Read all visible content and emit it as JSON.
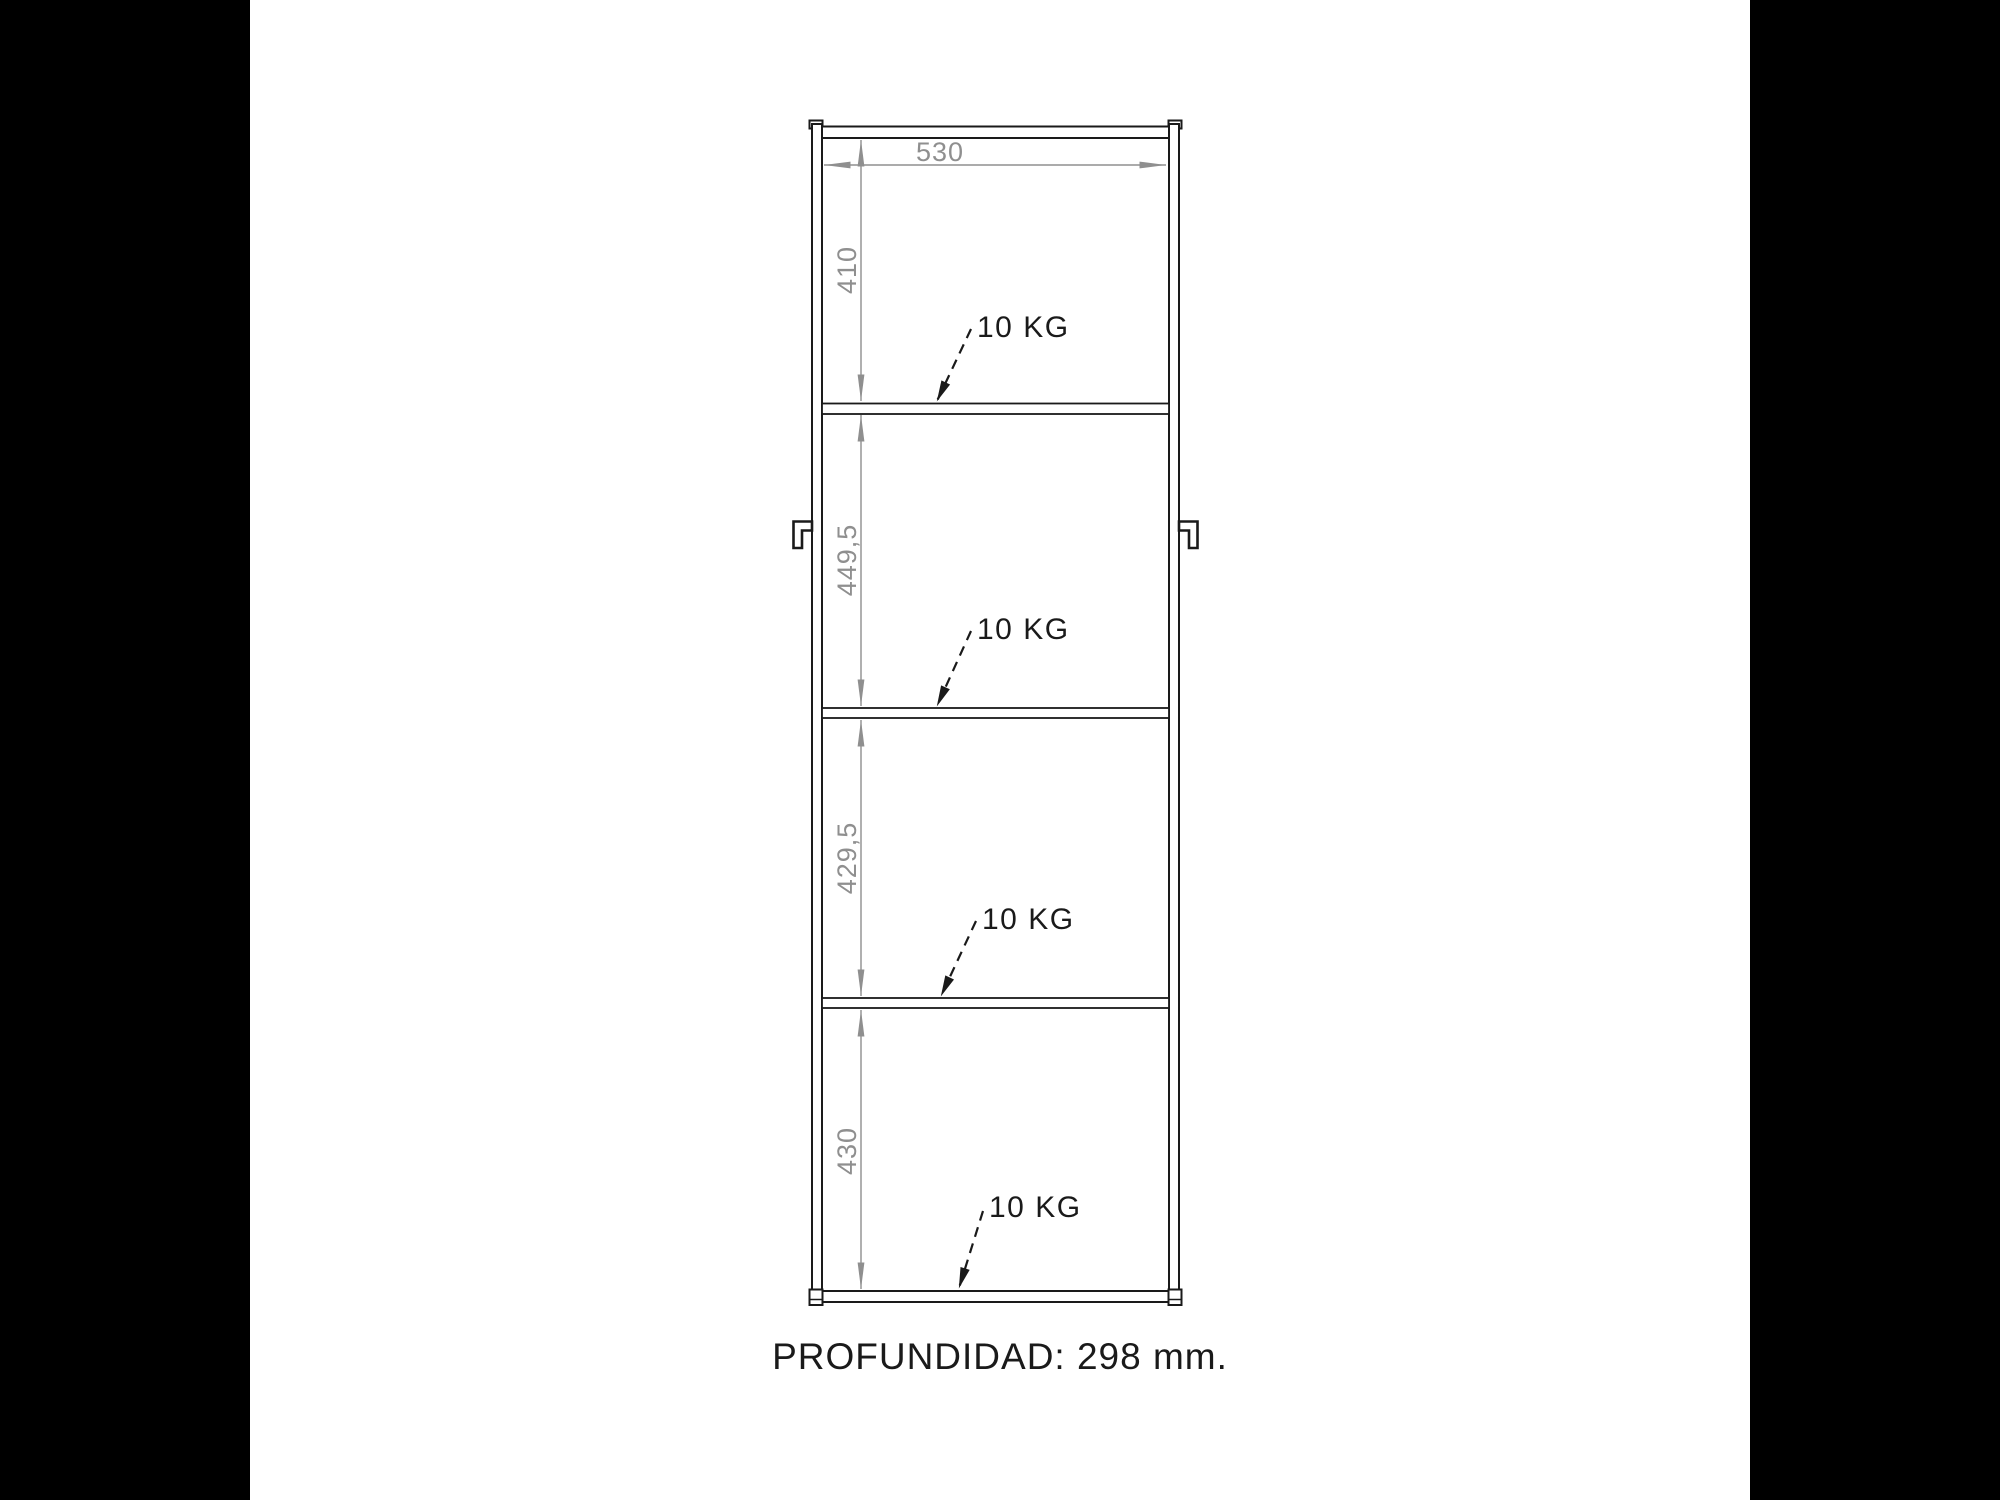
{
  "cabinet": {
    "width_dim": "530",
    "compartments": [
      {
        "height_dim": "410",
        "load": "10 KG"
      },
      {
        "height_dim": "449,5",
        "load": "10 KG"
      },
      {
        "height_dim": "429,5",
        "load": "10 KG"
      },
      {
        "height_dim": "430",
        "load": "10 KG"
      }
    ],
    "depth_note": "PROFUNDIDAD: 298 mm."
  },
  "colors": {
    "outline": "#1a1a1a",
    "dimension": "#8f8f8f",
    "background": "#ffffff",
    "letterbox": "#000000"
  }
}
